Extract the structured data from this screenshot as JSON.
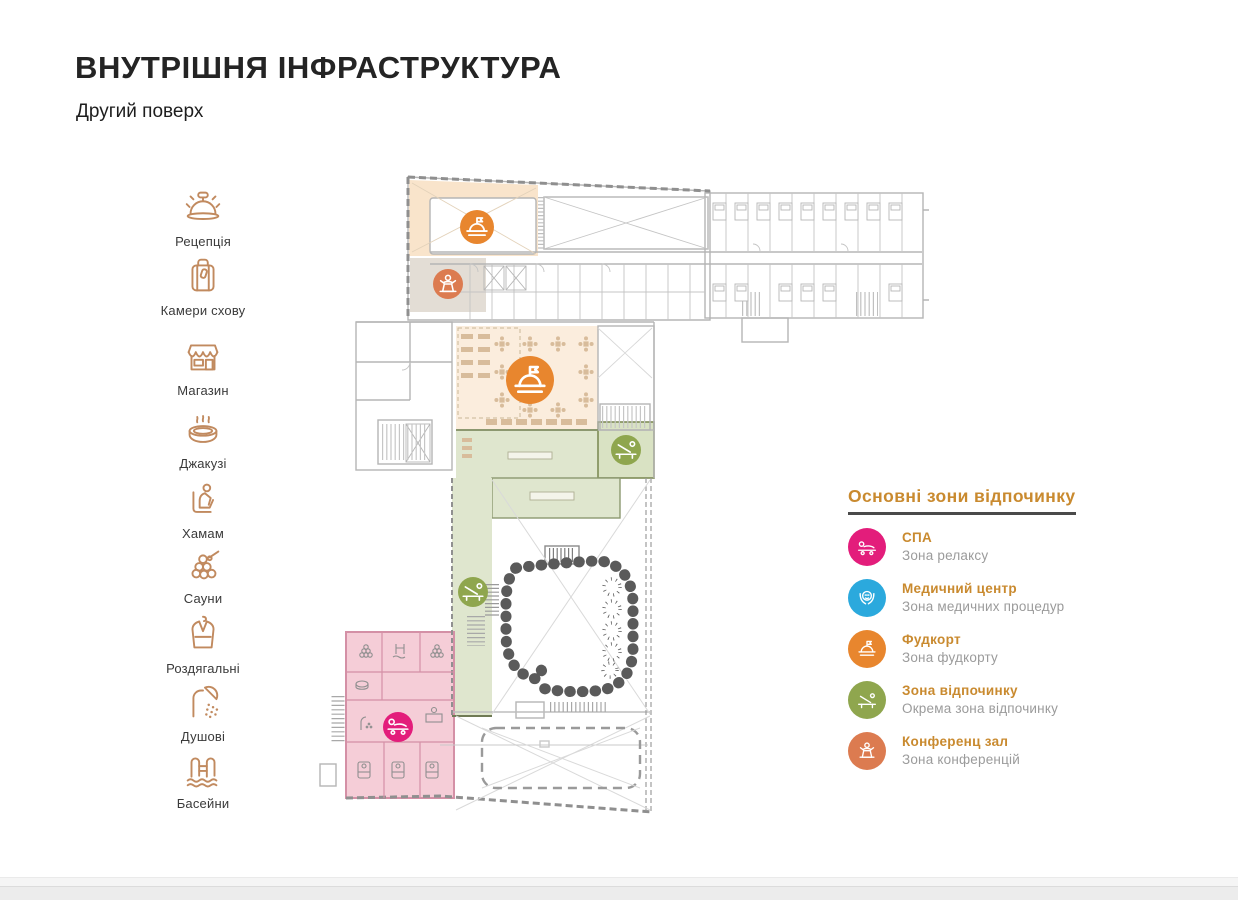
{
  "page": {
    "title": "ВНУТРІШНЯ ІНФРАСТРУКТУРА",
    "subtitle": "Другий поверх"
  },
  "sidebar": {
    "icon_color": "#C18A5F",
    "items": [
      {
        "label": "Рецепція",
        "icon": "reception-bell-icon"
      },
      {
        "label": "Камери схову",
        "icon": "luggage-icon"
      },
      {
        "label": "Магазин",
        "icon": "shop-icon"
      },
      {
        "label": "Джакузі",
        "icon": "jacuzzi-icon"
      },
      {
        "label": "Хамам",
        "icon": "hammam-icon"
      },
      {
        "label": "Сауни",
        "icon": "sauna-icon"
      },
      {
        "label": "Роздягальні",
        "icon": "changing-room-icon"
      },
      {
        "label": "Душові",
        "icon": "shower-icon"
      },
      {
        "label": "Басейни",
        "icon": "pool-icon"
      }
    ]
  },
  "legend": {
    "title": "Основні зони відпочинку",
    "title_color": "#C98A2F",
    "items": [
      {
        "name": "СПА",
        "desc": "Зона релаксу",
        "color": "#E31D7B",
        "icon": "spa-icon"
      },
      {
        "name": "Медичний центр",
        "desc": "Зона медичних процедур",
        "color": "#2BA9DD",
        "icon": "medical-icon"
      },
      {
        "name": "Фудкорт",
        "desc": "Зона фудкорту",
        "color": "#E8862E",
        "icon": "foodcourt-icon"
      },
      {
        "name": "Зона відпочинку",
        "desc": "Окрема зона відпочинку",
        "color": "#8FA64E",
        "icon": "rest-zone-icon"
      },
      {
        "name": "Конференц зал",
        "desc": "Зона конференцій",
        "color": "#DC7B50",
        "icon": "conference-icon"
      }
    ]
  },
  "floorplan": {
    "badges": [
      {
        "zone": "foodcourt-upper",
        "color": "#E8862E"
      },
      {
        "zone": "conference-hall",
        "color": "#DC7B50"
      },
      {
        "zone": "foodcourt-dining",
        "color": "#E8862E"
      },
      {
        "zone": "rest-zone-east",
        "color": "#8FA64E"
      },
      {
        "zone": "rest-zone-strip",
        "color": "#8FA64E"
      },
      {
        "zone": "spa",
        "color": "#E31D7B"
      }
    ],
    "zone_fills": {
      "foodcourt_upper": "#F9E4CB",
      "dining": "#FBEDDD",
      "conference": "#E3DDD5",
      "rest_green": "#DFE6CE",
      "spa_pink": "#F5CDD7"
    }
  }
}
